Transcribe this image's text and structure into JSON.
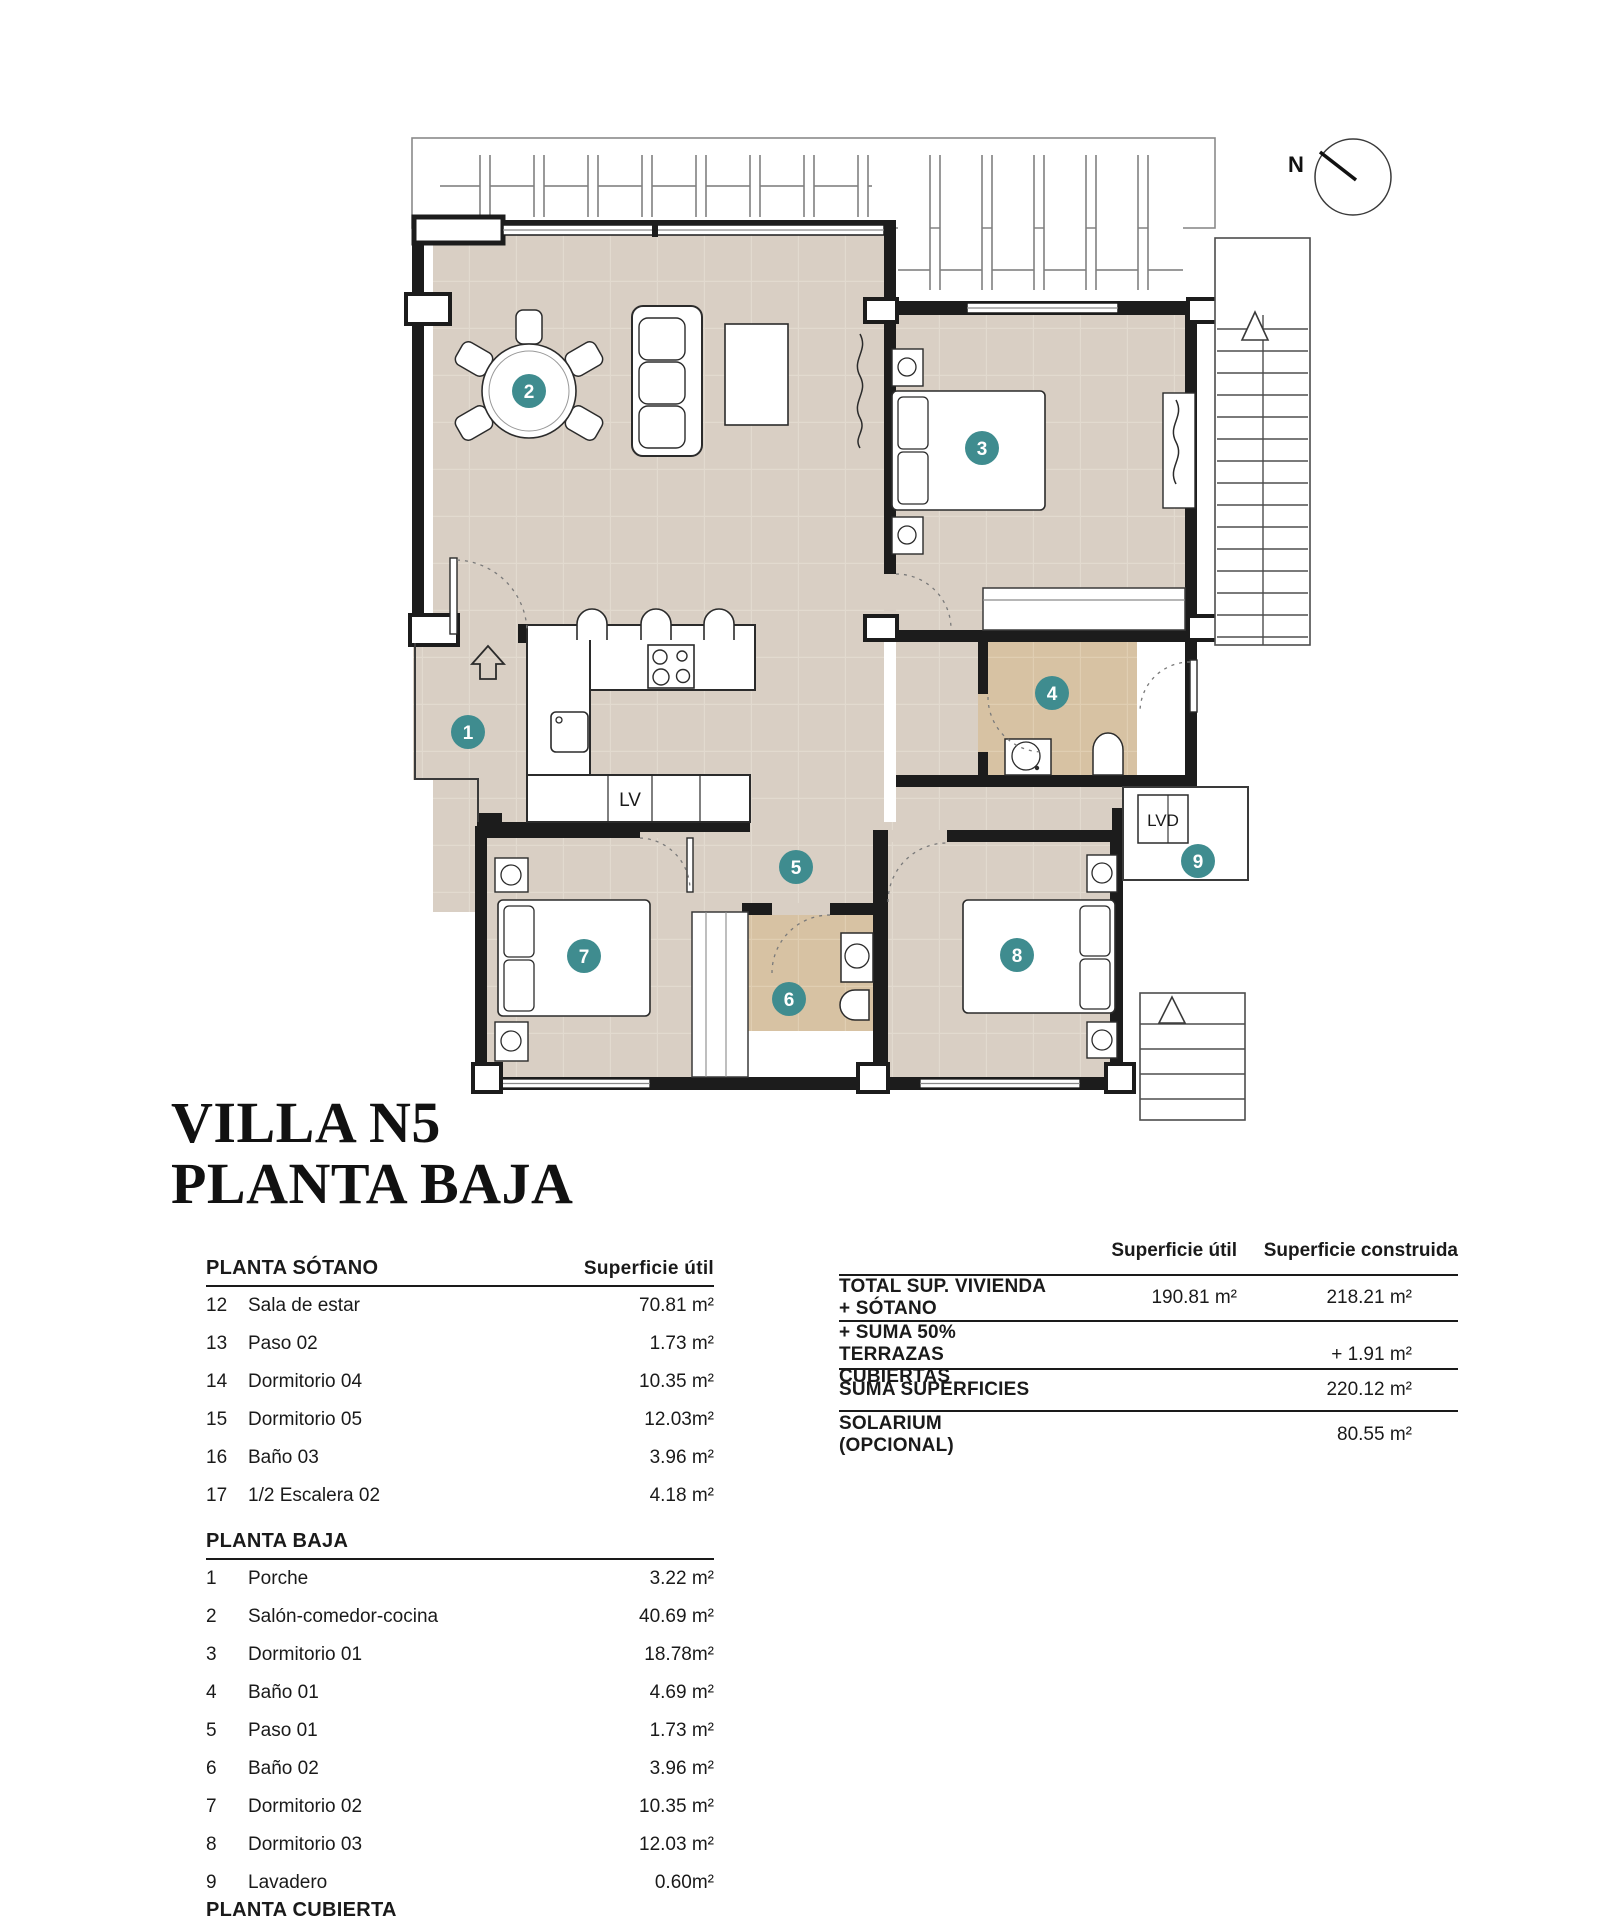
{
  "title": {
    "line1": "VILLA N5",
    "line2": "PLANTA BAJA"
  },
  "plan": {
    "north": "N",
    "lv": "LV",
    "lvd": "LVD",
    "room_labels": [
      "1",
      "2",
      "3",
      "4",
      "5",
      "6",
      "7",
      "8",
      "9"
    ],
    "colors": {
      "accent_teal": "#3f8c8f",
      "floor_beige": "#d9cfc4",
      "floor_bath_tan": "#d7c2a3",
      "wall_black": "#1c1c1c"
    }
  },
  "left_table": {
    "col_header": "Superficie útil",
    "sections": [
      {
        "header": "PLANTA SÓTANO",
        "rows": [
          [
            "12",
            "Sala de estar",
            "70.81 m²"
          ],
          [
            "13",
            "Paso 02",
            "1.73 m²"
          ],
          [
            "14",
            "Dormitorio 04",
            "10.35 m²"
          ],
          [
            "15",
            "Dormitorio 05",
            "12.03m²"
          ],
          [
            "16",
            "Baño 03",
            "3.96 m²"
          ],
          [
            "17",
            "1/2 Escalera 02",
            "4.18 m²"
          ]
        ]
      },
      {
        "header": "PLANTA BAJA",
        "rows": [
          [
            "1",
            "Porche",
            "3.22 m²"
          ],
          [
            "2",
            "Salón-comedor-cocina",
            "40.69 m²"
          ],
          [
            "3",
            "Dormitorio 01",
            "18.78m²"
          ],
          [
            "4",
            "Baño 01",
            "4.69 m²"
          ],
          [
            "5",
            "Paso 01",
            "1.73 m²"
          ],
          [
            "6",
            "Baño 02",
            "3.96 m²"
          ],
          [
            "7",
            "Dormitorio 02",
            "10.35 m²"
          ],
          [
            "8",
            "Dormitorio 03",
            "12.03 m²"
          ],
          [
            "9",
            "Lavadero",
            "0.60m²"
          ]
        ]
      },
      {
        "header": "PLANTA CUBIERTA",
        "rows": []
      }
    ]
  },
  "summary_table": {
    "col1_header": "Superficie útil",
    "col2_header": "Superficie construida",
    "rows": [
      {
        "label": "TOTAL SUP. VIVIENDA + SÓTANO",
        "util": "190.81  m²",
        "built": "218.21 m²"
      },
      {
        "label": "+ SUMA 50% TERRAZAS CUBIERTAS",
        "util": "",
        "built": "+ 1.91 m²"
      },
      {
        "label": "SUMA SUPERFICIES",
        "util": "",
        "built": "220.12 m²"
      },
      {
        "label": "SOLARIUM (OPCIONAL)",
        "util": "",
        "built": "80.55 m²"
      }
    ]
  }
}
